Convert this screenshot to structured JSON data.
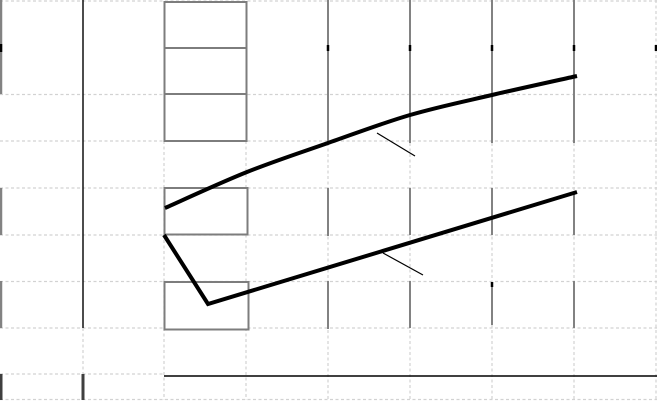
{
  "chart_data": {
    "type": "line",
    "title": "",
    "xlabel": "",
    "ylabel": "",
    "tick_labels_visible": false,
    "legend": "none",
    "canvas_px": {
      "width": 657,
      "height": 401
    },
    "series": [
      {
        "name": "upper-series",
        "smooth": true,
        "points_px": [
          [
            165,
            208
          ],
          [
            247,
            172
          ],
          [
            328,
            143
          ],
          [
            410,
            115
          ],
          [
            492,
            95
          ],
          [
            577,
            76
          ]
        ]
      },
      {
        "name": "lower-series",
        "smooth": false,
        "points_px": [
          [
            164,
            235
          ],
          [
            208,
            304
          ],
          [
            577,
            192
          ]
        ]
      }
    ],
    "leader_lines": [
      {
        "name": "upper-series-leader",
        "x1": 377,
        "y1": 133,
        "x2": 415,
        "y2": 156
      },
      {
        "name": "lower-series-leader",
        "x1": 383,
        "y1": 253,
        "x2": 423,
        "y2": 275
      }
    ],
    "empty_label_boxes": [
      {
        "x": 164.5,
        "y": 2,
        "w": 82,
        "h": 46
      },
      {
        "x": 164.5,
        "y": 48,
        "w": 82,
        "h": 46
      },
      {
        "x": 164.5,
        "y": 94,
        "w": 82,
        "h": 47
      },
      {
        "x": 164.5,
        "y": 188,
        "w": 83,
        "h": 46.5
      },
      {
        "x": 164.5,
        "y": 282,
        "w": 84,
        "h": 47.5
      }
    ],
    "axes": {
      "y_axis_line": {
        "x": 83,
        "y1": 0,
        "y2": 328
      },
      "x_baseline": {
        "y": 376,
        "x1": 164,
        "x2": 657
      },
      "left_edge_segments": [
        {
          "x": 1,
          "y1": 0,
          "y2": 94
        },
        {
          "x": 1,
          "y1": 188,
          "y2": 235
        },
        {
          "x": 1,
          "y1": 281,
          "y2": 328
        }
      ],
      "dark_stubs": [
        {
          "x": 1,
          "y1": 374,
          "y2": 400
        },
        {
          "x": 83,
          "y1": 374,
          "y2": 400
        }
      ],
      "black_ticks": [
        {
          "x": 1,
          "y1": 44,
          "y2": 52
        },
        {
          "x": 328,
          "y1": 45,
          "y2": 51
        },
        {
          "x": 410,
          "y1": 45,
          "y2": 51
        },
        {
          "x": 492,
          "y1": 45,
          "y2": 51
        },
        {
          "x": 574,
          "y1": 45,
          "y2": 51
        },
        {
          "x": 656,
          "y1": 45,
          "y2": 51
        },
        {
          "x": 492,
          "y1": 282,
          "y2": 287
        }
      ]
    },
    "grid": {
      "col_x": [
        1,
        83,
        164,
        246,
        328,
        410,
        492,
        574,
        656
      ],
      "row_y": [
        1,
        48,
        94.5,
        141,
        188,
        235,
        281.5,
        328,
        374,
        399.5
      ],
      "dashed_h": [
        {
          "y": 1,
          "x1": 0,
          "x2": 657
        },
        {
          "y": 94.5,
          "x1": 0,
          "x2": 657
        },
        {
          "y": 141,
          "x1": 0,
          "x2": 657
        },
        {
          "y": 188,
          "x1": 0,
          "x2": 657
        },
        {
          "y": 235,
          "x1": 0,
          "x2": 657
        },
        {
          "y": 281.5,
          "x1": 0,
          "x2": 657
        },
        {
          "y": 328,
          "x1": 0,
          "x2": 657
        },
        {
          "y": 374,
          "x1": 0,
          "x2": 164
        },
        {
          "y": 399.5,
          "x1": 0,
          "x2": 657
        }
      ],
      "dashed_v": [
        {
          "x": 83,
          "y1": 328,
          "y2": 374
        },
        {
          "x": 164,
          "y1": 141,
          "y2": 400
        },
        {
          "x": 246,
          "y1": 141,
          "y2": 400
        },
        {
          "x": 328,
          "y1": 143,
          "y2": 400
        },
        {
          "x": 410,
          "y1": 143,
          "y2": 400
        },
        {
          "x": 492,
          "y1": 143,
          "y2": 400
        },
        {
          "x": 574,
          "y1": 143,
          "y2": 400
        },
        {
          "x": 656,
          "y1": 0,
          "y2": 400
        }
      ],
      "solid_v_segments": [
        {
          "x": 328,
          "y1": 0,
          "y2": 143
        },
        {
          "x": 328,
          "y1": 188,
          "y2": 236
        },
        {
          "x": 328,
          "y1": 281,
          "y2": 329
        },
        {
          "x": 410,
          "y1": 0,
          "y2": 143
        },
        {
          "x": 410,
          "y1": 188,
          "y2": 235
        },
        {
          "x": 410,
          "y1": 281,
          "y2": 328
        },
        {
          "x": 492,
          "y1": 0,
          "y2": 143
        },
        {
          "x": 492,
          "y1": 188,
          "y2": 235
        },
        {
          "x": 492,
          "y1": 287,
          "y2": 325
        },
        {
          "x": 574,
          "y1": 0,
          "y2": 143
        },
        {
          "x": 574,
          "y1": 193,
          "y2": 235
        },
        {
          "x": 574,
          "y1": 281,
          "y2": 328
        }
      ]
    },
    "colors": {
      "background": "#ffffff",
      "series": "#000000",
      "leader": "#000000",
      "box_border": "#7d7d7d",
      "box_fill": "#ffffff",
      "grid_solid": "#828282",
      "grid_dashed": "#d2d2d2",
      "axis_black": "#000000",
      "axis_dark_stub": "#3f3f3f"
    }
  }
}
